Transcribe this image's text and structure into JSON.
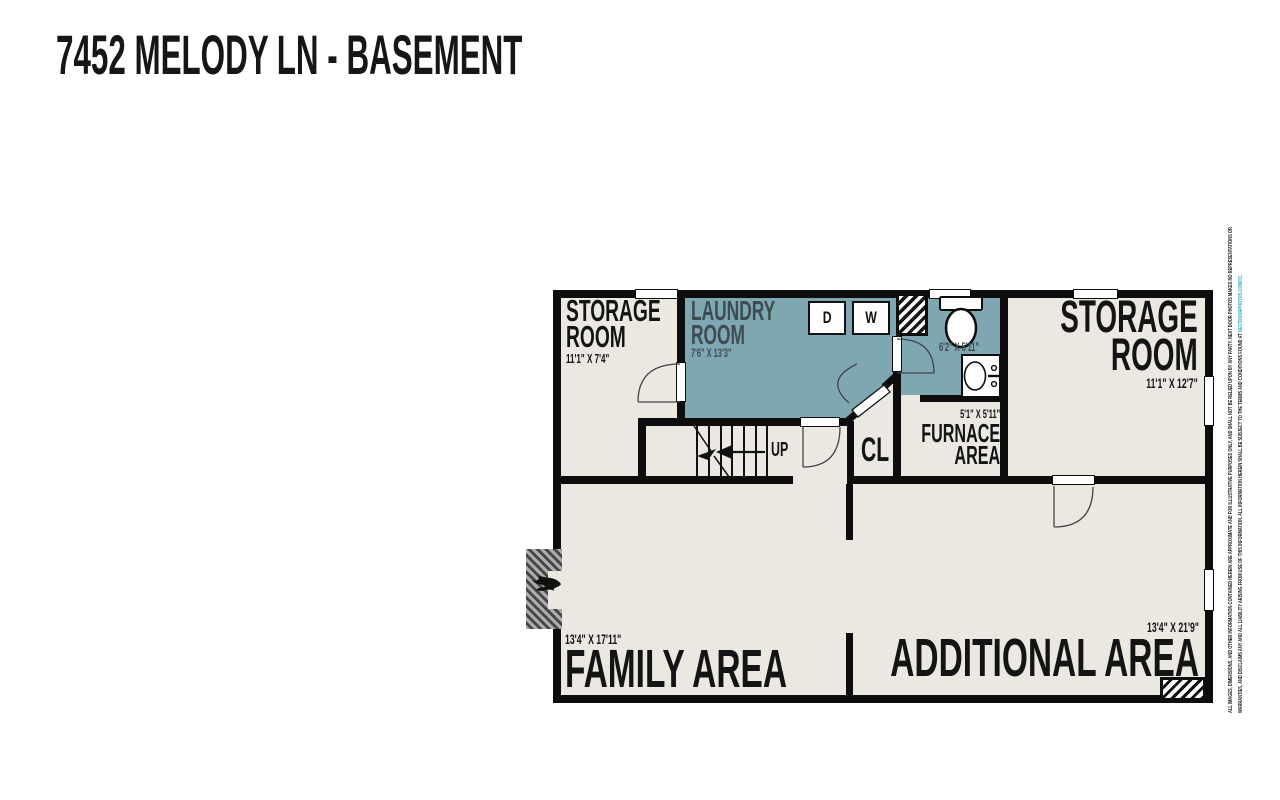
{
  "title": "7452 MELODY LN - BASEMENT",
  "rooms": {
    "storage_left": {
      "line1": "STORAGE",
      "line2": "ROOM",
      "dims": "11'1\" X 7'4\""
    },
    "laundry": {
      "line1": "LAUNDRY",
      "line2": "ROOM",
      "dims": "7'6\" X 13'3\""
    },
    "bathroom": {
      "dims": "6'2\" X 5'11\""
    },
    "furnace": {
      "dims": "5'1\" X 5'11\"",
      "line1": "FURNACE",
      "line2": "AREA"
    },
    "closet": {
      "label": "CL"
    },
    "storage_right": {
      "line1": "STORAGE",
      "line2": "ROOM",
      "dims": "11'1\" X 12'7\""
    },
    "family": {
      "name": "FAMILY AREA",
      "dims": "13'4\" X 17'11\""
    },
    "additional": {
      "name": "ADDITIONAL AREA",
      "dims": "13'4\" X 21'9\""
    }
  },
  "fixtures": {
    "dryer": "D",
    "washer": "W"
  },
  "stairs": {
    "direction_label": "UP"
  },
  "disclaimer": {
    "line1": "ALL IMAGES, DIMENSIONS, AND OTHER INFORMATION CONTAINED HEREIN ARE APPROXIMATE AND FOR ILLUSTRATIVE PURPOSES ONLY, AND SHALL NOT BE RELIED UPON BY ANY PARTY. NEXT DOOR PHOTOS MAKES NO REPRESENTATIONS OR",
    "line2": "WARRANTIES, AND DISCLAIMS ANY AND ALL LIABILITY ARISING FROM USE OF THIS INFORMATION. ALL INFORMATION HEREIN SHALL BE SUBJECT TO THE TERMS AND CONDITIONS FOUND AT ",
    "line2_link": "NEXTDOORPHOTOS.COM/TC."
  },
  "colors": {
    "floor": "#EAE8E0",
    "wet_room": "#7EA7B1",
    "wall": "#0d0d0d",
    "link": "#2FA9C9"
  }
}
